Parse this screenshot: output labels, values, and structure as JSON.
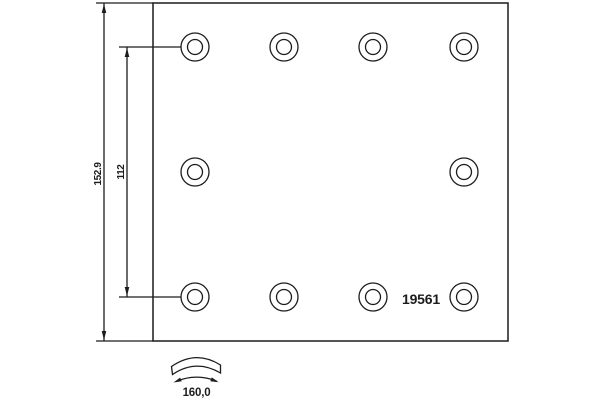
{
  "drawing": {
    "background_color": "#ffffff",
    "line_color": "#1c1c1c",
    "part_number": "19561",
    "dimensions": {
      "overall_height": "152.9",
      "rivet_row_spacing": "112",
      "lining_width": "160,0"
    },
    "rivet_holes": {
      "count": 10,
      "outer_radius": 14,
      "inner_radius": 7.5,
      "rows": [
        {
          "y": 47,
          "x": [
            195,
            284,
            373,
            464
          ]
        },
        {
          "y": 172,
          "x": [
            195,
            464
          ]
        },
        {
          "y": 297,
          "x": [
            195,
            284,
            373,
            464
          ]
        }
      ]
    }
  }
}
